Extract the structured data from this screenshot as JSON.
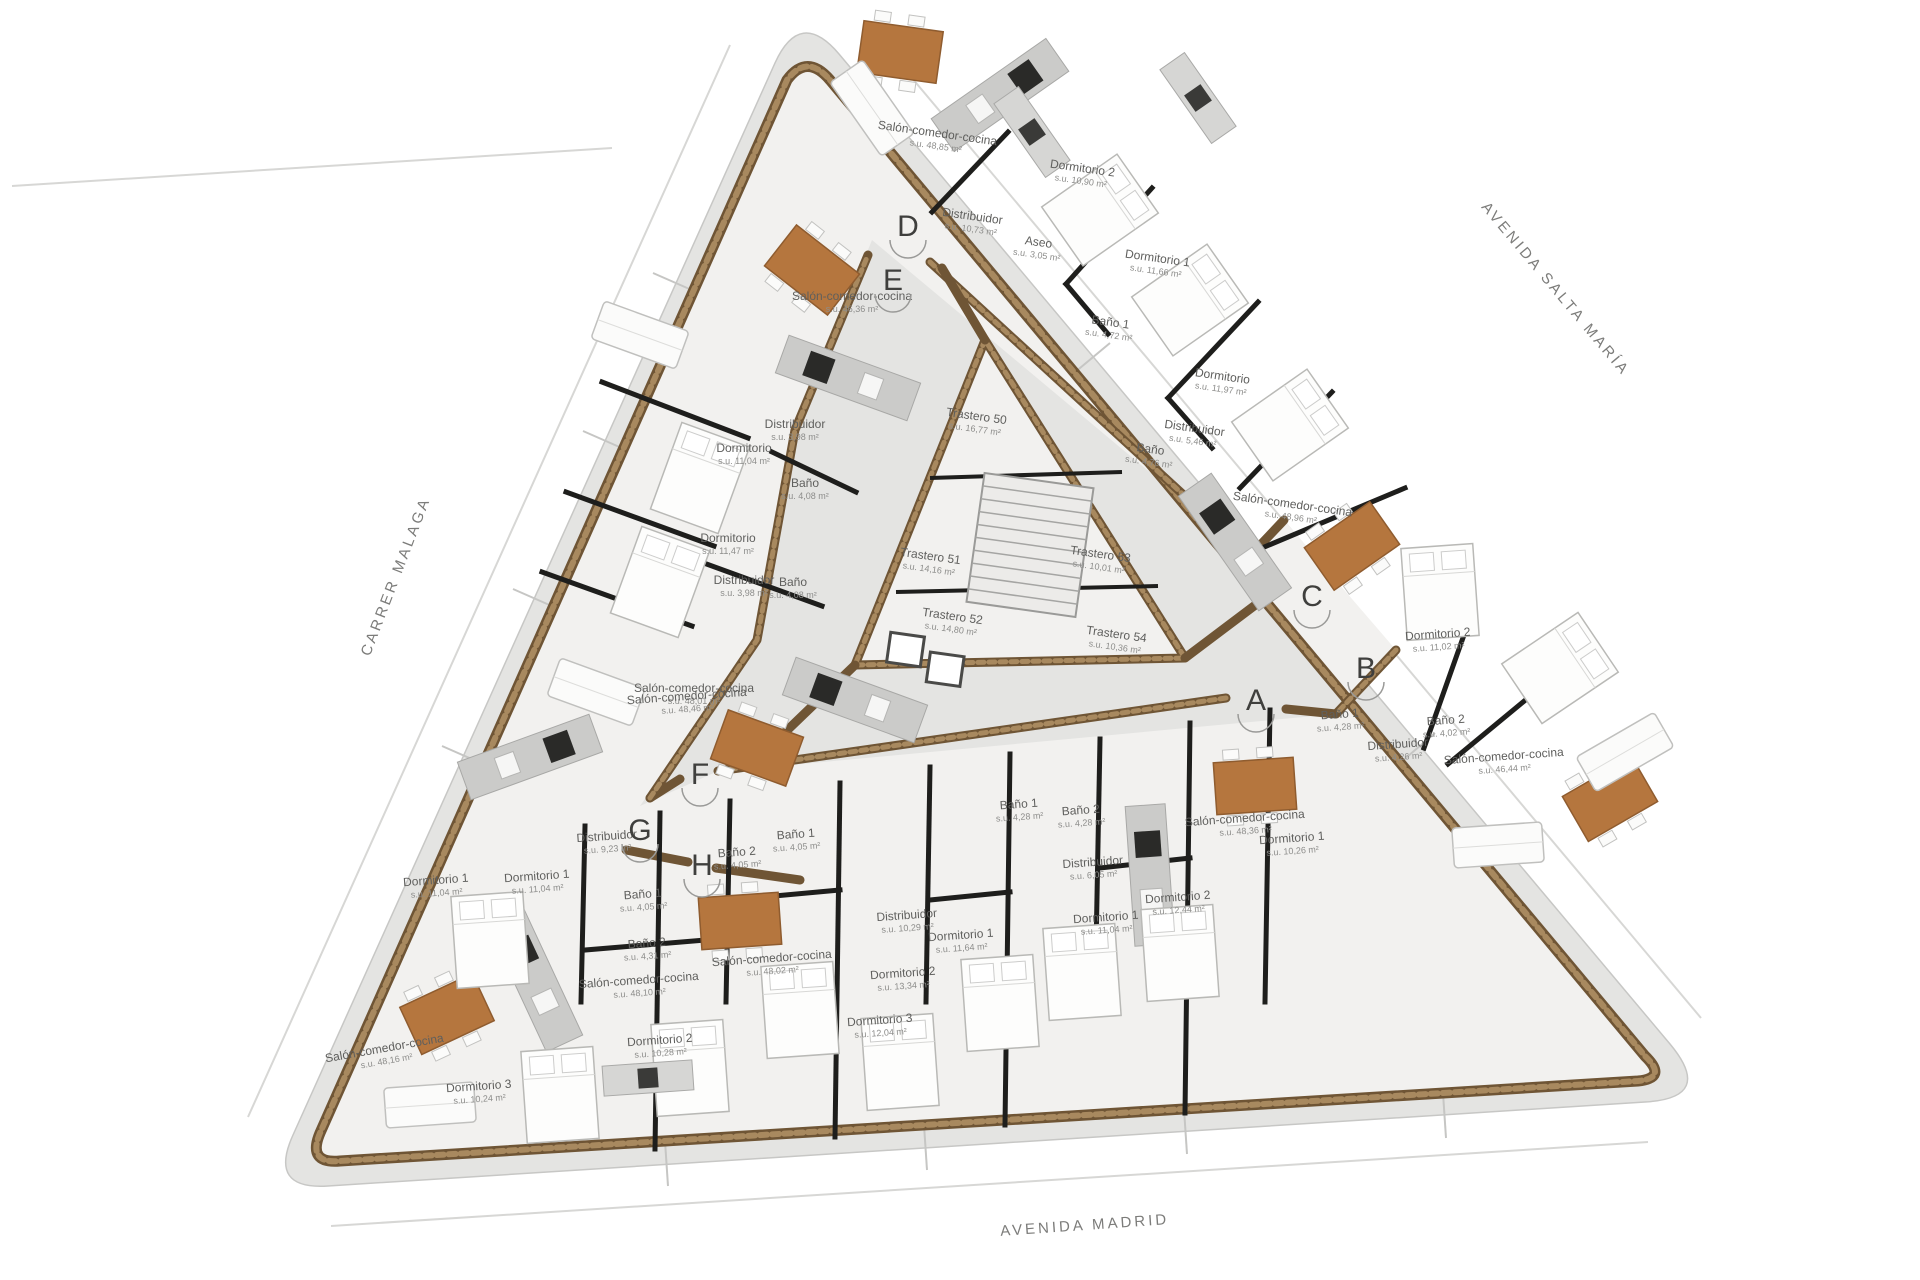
{
  "plan": {
    "streets": [
      {
        "name": "CARRER MALAGA",
        "x": 400,
        "y": 578,
        "rot": -69
      },
      {
        "name": "AVENIDA SALTA MARÍA",
        "x": 1552,
        "y": 292,
        "rot": 50
      },
      {
        "name": "AVENIDA MADRID",
        "x": 1085,
        "y": 1230,
        "rot": -4
      }
    ],
    "entrances": [
      {
        "letter": "A",
        "x": 1256,
        "y": 702
      },
      {
        "letter": "B",
        "x": 1366,
        "y": 670
      },
      {
        "letter": "C",
        "x": 1312,
        "y": 598
      },
      {
        "letter": "D",
        "x": 908,
        "y": 228
      },
      {
        "letter": "E",
        "x": 893,
        "y": 282
      },
      {
        "letter": "F",
        "x": 700,
        "y": 776
      },
      {
        "letter": "G",
        "x": 640,
        "y": 832
      },
      {
        "letter": "H",
        "x": 702,
        "y": 867
      }
    ],
    "rooms": [
      {
        "label": "Salón-comedor-cocina",
        "area": "s.u. 48,85 m²",
        "x": 937,
        "y": 137,
        "rot": 8
      },
      {
        "label": "Dormitorio 2",
        "area": "s.u. 10,90 m²",
        "x": 1082,
        "y": 172,
        "rot": 8
      },
      {
        "label": "Distribuidor",
        "area": "s.u. 10,73 m²",
        "x": 972,
        "y": 220,
        "rot": 8
      },
      {
        "label": "Aseo",
        "area": "s.u. 3,05 m²",
        "x": 1038,
        "y": 246,
        "rot": 8
      },
      {
        "label": "Dormitorio 1",
        "area": "s.u. 11,66 m²",
        "x": 1157,
        "y": 262,
        "rot": 8
      },
      {
        "label": "Baño 1",
        "area": "s.u. 4,72 m²",
        "x": 1110,
        "y": 326,
        "rot": 8
      },
      {
        "label": "Dormitorio",
        "area": "s.u. 11,97 m²",
        "x": 1222,
        "y": 380,
        "rot": 8
      },
      {
        "label": "Distribuidor",
        "area": "s.u. 5,46 m²",
        "x": 1194,
        "y": 432,
        "rot": 8
      },
      {
        "label": "Baño",
        "area": "s.u. 4,76 m²",
        "x": 1150,
        "y": 453,
        "rot": 8
      },
      {
        "label": "Salón-comedor-cocina",
        "area": "s.u. 48,96 m²",
        "x": 1292,
        "y": 508,
        "rot": 8
      },
      {
        "label": "Salón-comedor-cocina",
        "area": "s.u. 46,36 m²",
        "x": 852,
        "y": 300,
        "rot": 0
      },
      {
        "label": "Distribuidor",
        "area": "s.u. 3,98 m²",
        "x": 795,
        "y": 428,
        "rot": 0
      },
      {
        "label": "Dormitorio",
        "area": "s.u. 11,04 m²",
        "x": 744,
        "y": 452,
        "rot": 0
      },
      {
        "label": "Baño",
        "area": "s.u. 4,08 m²",
        "x": 805,
        "y": 487,
        "rot": 0
      },
      {
        "label": "Dormitorio",
        "area": "s.u. 11,47 m²",
        "x": 728,
        "y": 542,
        "rot": 0
      },
      {
        "label": "Distribuidor",
        "area": "s.u. 3,98 m²",
        "x": 744,
        "y": 584,
        "rot": 0
      },
      {
        "label": "Baño",
        "area": "s.u. 4,08 m²",
        "x": 793,
        "y": 586,
        "rot": 0
      },
      {
        "label": "Salón-comedor-cocina",
        "area": "s.u. 48,01 m²",
        "x": 694,
        "y": 692,
        "rot": 0
      },
      {
        "label": "Trastero 50",
        "area": "s.u. 16,77 m²",
        "x": 976,
        "y": 420,
        "rot": 8
      },
      {
        "label": "Trastero 51",
        "area": "s.u. 14,16 m²",
        "x": 930,
        "y": 560,
        "rot": 8
      },
      {
        "label": "Trastero 52",
        "area": "s.u. 14,80 m²",
        "x": 952,
        "y": 620,
        "rot": 8
      },
      {
        "label": "Trastero 53",
        "area": "s.u. 10,01 m²",
        "x": 1100,
        "y": 558,
        "rot": 8
      },
      {
        "label": "Trastero 54",
        "area": "s.u. 10,36 m²",
        "x": 1116,
        "y": 638,
        "rot": 8
      },
      {
        "label": "Dormitorio 2",
        "area": "s.u. 11,02 m²",
        "x": 1438,
        "y": 638,
        "rot": -4
      },
      {
        "label": "Baño 2",
        "area": "s.u. 4,02 m²",
        "x": 1446,
        "y": 724,
        "rot": -4
      },
      {
        "label": "Distribuidor",
        "area": "s.u. 4,26 m²",
        "x": 1398,
        "y": 748,
        "rot": -4
      },
      {
        "label": "Salón-comedor-cocina",
        "area": "s.u. 46,44 m²",
        "x": 1504,
        "y": 760,
        "rot": -4
      },
      {
        "label": "Dormitorio 1",
        "area": "s.u. 10,26 m²",
        "x": 1292,
        "y": 842,
        "rot": -4
      },
      {
        "label": "Baño 1",
        "area": "s.u. 4,28 m²",
        "x": 1340,
        "y": 718,
        "rot": -4
      },
      {
        "label": "Salón-comedor-cocina",
        "area": "s.u. 48,36 m²",
        "x": 1245,
        "y": 822,
        "rot": -4
      },
      {
        "label": "Dormitorio 1",
        "area": "s.u. 11,04 m²",
        "x": 1106,
        "y": 921,
        "rot": -4
      },
      {
        "label": "Dormitorio 2",
        "area": "s.u. 12,44 m²",
        "x": 1178,
        "y": 901,
        "rot": -4
      },
      {
        "label": "Distribuidor",
        "area": "s.u. 6,05 m²",
        "x": 1093,
        "y": 866,
        "rot": -4
      },
      {
        "label": "Baño 1",
        "area": "s.u. 4,28 m²",
        "x": 1019,
        "y": 808,
        "rot": -4
      },
      {
        "label": "Baño 2",
        "area": "s.u. 4,28 m²",
        "x": 1081,
        "y": 814,
        "rot": -4
      },
      {
        "label": "Baño 1",
        "area": "s.u. 4,05 m²",
        "x": 796,
        "y": 838,
        "rot": -4
      },
      {
        "label": "Baño 2",
        "area": "s.u. 4,05 m²",
        "x": 737,
        "y": 856,
        "rot": -4
      },
      {
        "label": "Distribuidor",
        "area": "s.u. 10,29 m²",
        "x": 907,
        "y": 919,
        "rot": -4
      },
      {
        "label": "Dormitorio 1",
        "area": "s.u. 11,64 m²",
        "x": 961,
        "y": 939,
        "rot": -4
      },
      {
        "label": "Dormitorio 2",
        "area": "s.u. 13,34 m²",
        "x": 903,
        "y": 977,
        "rot": -4
      },
      {
        "label": "Dormitorio 3",
        "area": "s.u. 12,04 m²",
        "x": 880,
        "y": 1024,
        "rot": -4
      },
      {
        "label": "Salón-comedor-cocina",
        "area": "s.u. 48,02 m²",
        "x": 772,
        "y": 962,
        "rot": -4
      },
      {
        "label": "Salón-comedor-cocina",
        "area": "s.u. 48,46 m²",
        "x": 687,
        "y": 700,
        "rot": -4
      },
      {
        "label": "Distribuidor",
        "area": "s.u. 9,23 m²",
        "x": 607,
        "y": 840,
        "rot": -4
      },
      {
        "label": "Dormitorio 1",
        "area": "s.u. 11,04 m²",
        "x": 537,
        "y": 880,
        "rot": -4
      },
      {
        "label": "Baño 1",
        "area": "s.u. 4,05 m²",
        "x": 643,
        "y": 898,
        "rot": -4
      },
      {
        "label": "Baño 2",
        "area": "s.u. 4,31 m²",
        "x": 647,
        "y": 947,
        "rot": -4
      },
      {
        "label": "Salón-comedor-cocina",
        "area": "s.u. 48,10 m²",
        "x": 639,
        "y": 984,
        "rot": -4
      },
      {
        "label": "Dormitorio 1",
        "area": "s.u. 11,04 m²",
        "x": 436,
        "y": 884,
        "rot": -4
      },
      {
        "label": "Salón-comedor-cocina",
        "area": "s.u. 48,16 m²",
        "x": 385,
        "y": 1052,
        "rot": -10
      },
      {
        "label": "Dormitorio 2",
        "area": "s.u. 10,28 m²",
        "x": 660,
        "y": 1044,
        "rot": -4
      },
      {
        "label": "Dormitorio 3",
        "area": "s.u. 10,24 m²",
        "x": 479,
        "y": 1090,
        "rot": -4
      }
    ],
    "furniture": [
      {
        "t": "table",
        "x": 900,
        "y": 52,
        "r": 8
      },
      {
        "t": "table",
        "x": 812,
        "y": 270,
        "r": 38
      },
      {
        "t": "table",
        "x": 757,
        "y": 748,
        "r": 20
      },
      {
        "t": "table",
        "x": 447,
        "y": 1014,
        "r": -25
      },
      {
        "t": "table",
        "x": 740,
        "y": 921,
        "r": -4
      },
      {
        "t": "table",
        "x": 1255,
        "y": 786,
        "r": -4
      },
      {
        "t": "table",
        "x": 1352,
        "y": 546,
        "r": -35
      },
      {
        "t": "table",
        "x": 1610,
        "y": 799,
        "r": -30
      },
      {
        "t": "kitchen",
        "x": 1000,
        "y": 95,
        "r": 55
      },
      {
        "t": "kitchen",
        "x": 848,
        "y": 378,
        "r": -70
      },
      {
        "t": "kitchen",
        "x": 855,
        "y": 700,
        "r": -70
      },
      {
        "t": "kitchen",
        "x": 535,
        "y": 980,
        "r": -25
      },
      {
        "t": "kitchen",
        "x": 530,
        "y": 757,
        "r": 70
      },
      {
        "t": "kitchen",
        "x": 1235,
        "y": 542,
        "r": -35
      },
      {
        "t": "kitchen",
        "x": 1150,
        "y": 875,
        "r": -4
      },
      {
        "t": "bed",
        "x": 1100,
        "y": 210,
        "r": 55
      },
      {
        "t": "bed",
        "x": 1190,
        "y": 300,
        "r": 55
      },
      {
        "t": "bed",
        "x": 1290,
        "y": 425,
        "r": 55
      },
      {
        "t": "bed",
        "x": 700,
        "y": 478,
        "r": 20
      },
      {
        "t": "bed",
        "x": 660,
        "y": 582,
        "r": 20
      },
      {
        "t": "bed",
        "x": 490,
        "y": 940,
        "r": -4
      },
      {
        "t": "bed",
        "x": 560,
        "y": 1095,
        "r": -4
      },
      {
        "t": "bed",
        "x": 690,
        "y": 1068,
        "r": -4
      },
      {
        "t": "bed",
        "x": 800,
        "y": 1010,
        "r": -4
      },
      {
        "t": "bed",
        "x": 900,
        "y": 1062,
        "r": -4
      },
      {
        "t": "bed",
        "x": 1000,
        "y": 1003,
        "r": -4
      },
      {
        "t": "bed",
        "x": 1082,
        "y": 972,
        "r": -4
      },
      {
        "t": "bed",
        "x": 1180,
        "y": 953,
        "r": -4
      },
      {
        "t": "bed",
        "x": 1440,
        "y": 592,
        "r": -4
      },
      {
        "t": "bed",
        "x": 1560,
        "y": 668,
        "r": 56
      },
      {
        "t": "sofa",
        "x": 872,
        "y": 108,
        "r": 55
      },
      {
        "t": "sofa",
        "x": 640,
        "y": 335,
        "r": 20
      },
      {
        "t": "sofa",
        "x": 596,
        "y": 692,
        "r": 20
      },
      {
        "t": "sofa",
        "x": 430,
        "y": 1105,
        "r": -4
      },
      {
        "t": "sofa",
        "x": 1498,
        "y": 845,
        "r": -4
      },
      {
        "t": "sofa",
        "x": 1625,
        "y": 752,
        "r": -30
      },
      {
        "t": "cabinet",
        "x": 1032,
        "y": 132,
        "r": 55
      },
      {
        "t": "cabinet",
        "x": 1198,
        "y": 98,
        "r": 55
      },
      {
        "t": "cabinet",
        "x": 648,
        "y": 1078,
        "r": -4
      }
    ],
    "colors": {
      "wall_brown": "#6f5535",
      "wall_hatch": "#a8895f",
      "wall_dark": "#1e1e1c",
      "plot_gray": "#e4e4e2",
      "floor": "#f2f1ef",
      "table_brown": "#b5763e",
      "counter_gray": "#cbcbc9",
      "appliance_black": "#2a2a28"
    }
  }
}
